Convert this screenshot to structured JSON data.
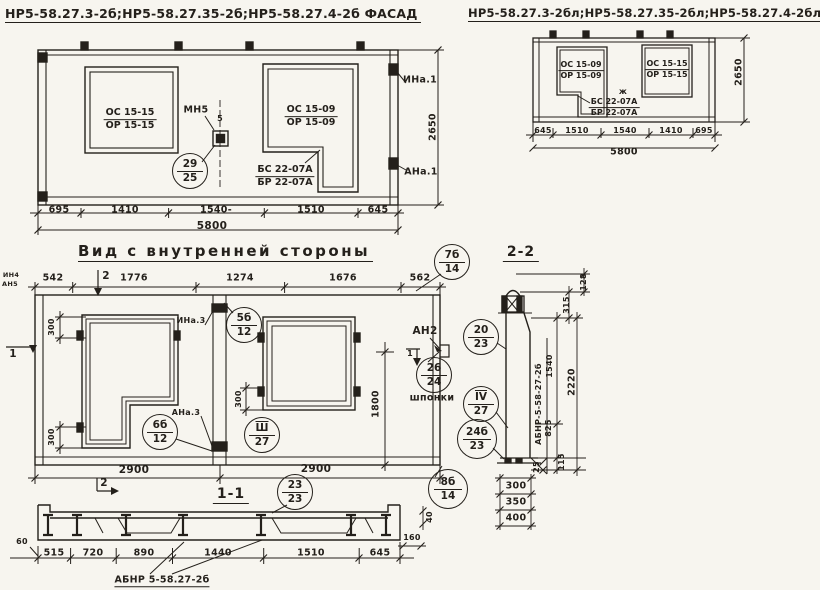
{
  "meta": {
    "ink_color": "#24201b",
    "paper_color": "#f7f5ef"
  },
  "titles": {
    "facadeL": "НР5-58.27.3-2б;НР5-58.27.35-2б;НР5-58.27.4-2б ФАСАД",
    "facadeR": "НР5-58.27.3-2бл;НР5-58.27.35-2бл;НР5-58.27.4-2бл ФАСАД",
    "inner": "Вид с внутренней стороны",
    "s1": "1-1",
    "s2": "2-2"
  },
  "facadeL": {
    "win1a": "ОС 15-15",
    "win1b": "ОР 15-15",
    "win2a": "ОС 15-09",
    "win2b": "ОР 15-09",
    "beamA": "БС 22-07А",
    "beamB": "БР 22-07А",
    "mn5": "МН5",
    "gap5": "5",
    "ina": "ИНа.1",
    "ana": "АНа.1",
    "h": "2650",
    "dims": [
      "695",
      "1410",
      "1540-",
      "1510",
      "645"
    ],
    "total": "5800",
    "circ": {
      "t": "29",
      "b": "25"
    }
  },
  "facadeR": {
    "win1a": "ОС 15-09",
    "win1b": "ОР 15-09",
    "win2a": "ОС 15-15",
    "win2b": "ОР 15-15",
    "beamA": "БС 22-07А",
    "beamB": "БР 22-07А",
    "zh": "ж",
    "h": "2650",
    "dims": [
      "645",
      "1510",
      "1540",
      "1410",
      "695"
    ],
    "total": "5800"
  },
  "inner": {
    "topDims": [
      "542",
      "1776",
      "1274",
      "1676",
      "562"
    ],
    "micro1": "ИН4",
    "micro2": "АН5",
    "m1": "1",
    "m2": "2",
    "d300": "300",
    "d1800": "1800",
    "d2900": "2900",
    "an2": "АН2",
    "shponki": "шпонки",
    "ina3": "ИНа.3",
    "ana3": "АНа.3",
    "c5b": {
      "t": "5б",
      "b": "12"
    },
    "c6b": {
      "t": "6б",
      "b": "12"
    },
    "c3": {
      "t": "Ш",
      "b": "27"
    },
    "c26": {
      "t": "26",
      "b": "24"
    },
    "c7b": {
      "t": "7б",
      "b": "14"
    },
    "c8b": {
      "t": "8б",
      "b": "14"
    }
  },
  "s2": {
    "mark": "АБНР-5-58-27-2б",
    "d128": "128",
    "d315": "315",
    "d1540": "1540",
    "d2220": "2220",
    "d825": "825",
    "d25": "25",
    "d115": "115",
    "stack": [
      "300",
      "350",
      "400"
    ],
    "c20": {
      "t": "20",
      "b": "23"
    },
    "c4": {
      "t": "IV",
      "b": "27"
    },
    "c24": {
      "t": "24б",
      "b": "23"
    }
  },
  "s1": {
    "dims": [
      "515",
      "720",
      "890",
      "1440",
      "1510",
      "645"
    ],
    "d60": "60",
    "d160": "160",
    "d40": "40",
    "label": "АБНР 5-58.27-2б",
    "c23": {
      "t": "23",
      "b": "23"
    }
  }
}
